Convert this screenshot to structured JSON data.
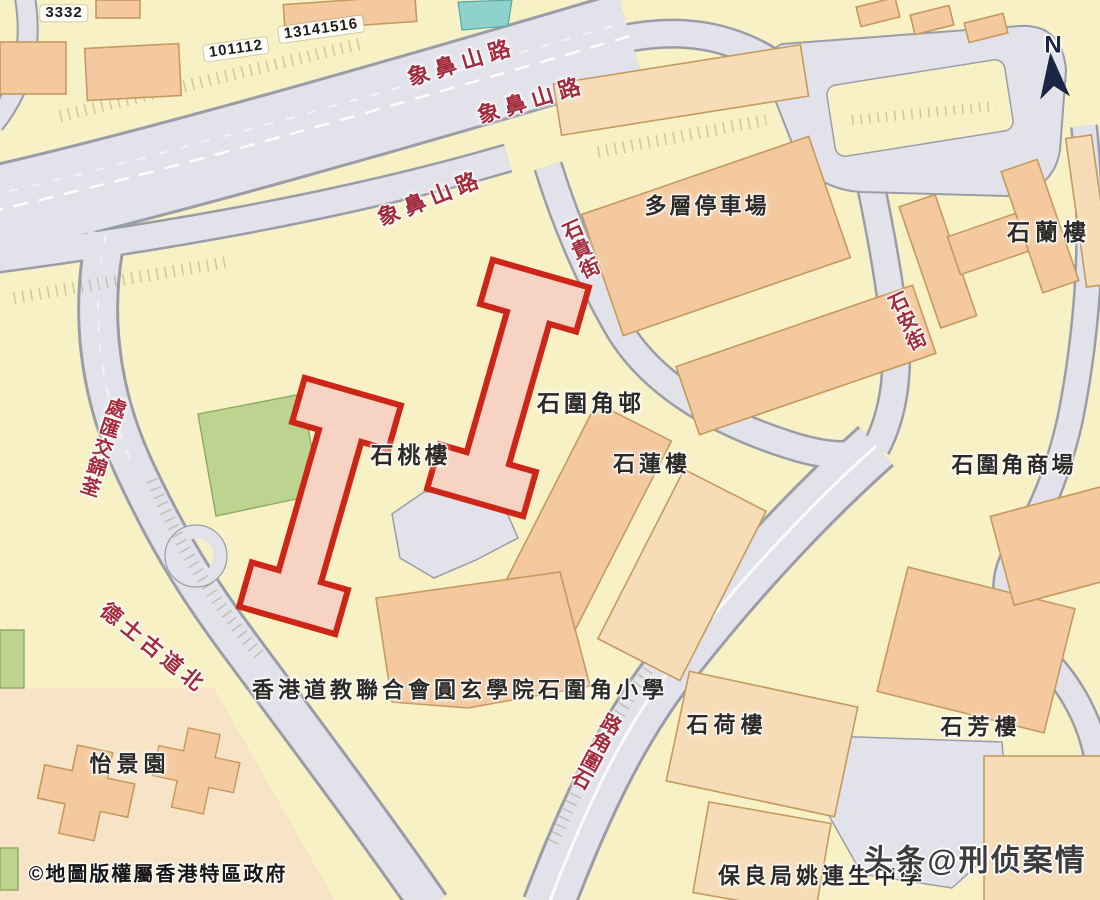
{
  "map": {
    "region_name": "石圍角邨",
    "highlighted_building": "石桃樓",
    "colors": {
      "base": "#f8f1c6",
      "road": "#e2e3ea",
      "roadEdge": "#9a9da8",
      "building": "#f4c99f",
      "buildingLight": "#f7dcb8",
      "buildingEdge": "#c49a5e",
      "paleBlock": "#f7e3c5",
      "green": "#bcd48f",
      "greenEdge": "#8fa95e",
      "teal": "#8fd2cc",
      "redLine": "#cd2518",
      "redFill": "#f6d3c3",
      "roadLabel": "#a32b3e",
      "placeLabel": "#2b2a27",
      "watermark": "#3c3c3c",
      "compass": "#1b2544"
    },
    "compass": {
      "label": "N"
    },
    "labels": [
      {
        "id": "lot-label-3332",
        "type": "pill",
        "text": "3332",
        "x": 64,
        "y": 13,
        "rot": 0,
        "size": 15,
        "ls": 1
      },
      {
        "id": "lot-label-101112",
        "type": "pill",
        "text": "101112",
        "x": 236,
        "y": 49,
        "rot": -8,
        "size": 15,
        "ls": 1
      },
      {
        "id": "lot-label-13141516",
        "type": "pill",
        "text": "13141516",
        "x": 321,
        "y": 29,
        "rot": -8,
        "size": 15,
        "ls": 1
      },
      {
        "id": "road-label-cheung-pei-shan-road-1",
        "type": "road",
        "text": "象鼻山路",
        "x": 462,
        "y": 63,
        "rot": -17,
        "size": 22,
        "ls": 6
      },
      {
        "id": "road-label-cheung-pei-shan-road-2",
        "type": "road",
        "text": "象鼻山路",
        "x": 532,
        "y": 101,
        "rot": -17,
        "size": 22,
        "ls": 6
      },
      {
        "id": "road-label-cheung-pei-shan-road-3",
        "type": "road",
        "text": "象鼻山路",
        "x": 431,
        "y": 199,
        "rot": -22,
        "size": 22,
        "ls": 6
      },
      {
        "id": "road-label-shek-kwai-street",
        "type": "road",
        "text": "石貴街",
        "x": 582,
        "y": 250,
        "rot": -24,
        "size": 20,
        "vertical": true
      },
      {
        "id": "road-label-shek-on-street",
        "type": "road",
        "text": "石安街",
        "x": 908,
        "y": 322,
        "rot": -25,
        "size": 20,
        "vertical": true
      },
      {
        "id": "road-label-tsuen-kam-interchange",
        "type": "road",
        "text": "荃錦交匯處",
        "x": 103,
        "y": 449,
        "rot": 18,
        "size": 20,
        "vertical": true,
        "reverse": true
      },
      {
        "id": "road-label-texaco-road-north",
        "type": "road",
        "text": "德士古道北",
        "x": 153,
        "y": 649,
        "rot": 39,
        "size": 21,
        "ls": 5
      },
      {
        "id": "road-label-shek-wai-kok-road",
        "type": "road",
        "text": "石圍角路",
        "x": 596,
        "y": 753,
        "rot": 28,
        "size": 20,
        "vertical": true,
        "reverse": true
      },
      {
        "id": "place-label-multistorey-car-park",
        "type": "place",
        "text": "多層停車場",
        "x": 707,
        "y": 207,
        "rot": 0,
        "size": 22,
        "ls": 3
      },
      {
        "id": "place-label-shek-lan-house",
        "type": "place",
        "text": "石蘭樓",
        "x": 1049,
        "y": 233,
        "rot": 0,
        "size": 23,
        "ls": 5
      },
      {
        "id": "place-label-shek-wai-kok-estate",
        "type": "place",
        "text": "石圍角邨",
        "x": 591,
        "y": 404,
        "rot": 0,
        "size": 23,
        "ls": 4
      },
      {
        "id": "place-label-shek-to-house",
        "type": "place",
        "text": "石桃樓",
        "x": 411,
        "y": 456,
        "rot": 0,
        "size": 23,
        "ls": 4
      },
      {
        "id": "place-label-shek-lin-house",
        "type": "place",
        "text": "石蓮樓",
        "x": 652,
        "y": 465,
        "rot": 0,
        "size": 22,
        "ls": 4
      },
      {
        "id": "place-label-shek-wai-kok-shopping-centre",
        "type": "place",
        "text": "石圍角商場",
        "x": 1014,
        "y": 466,
        "rot": 0,
        "size": 22,
        "ls": 3
      },
      {
        "id": "place-label-yuen-yuen-institute-primary-school",
        "type": "place",
        "text": "香港道教聯合會圓玄學院石圍角小學",
        "x": 460,
        "y": 691,
        "rot": 0,
        "size": 22,
        "ls": 4
      },
      {
        "id": "place-label-yee-king-garden",
        "type": "place",
        "text": "怡景園",
        "x": 130,
        "y": 765,
        "rot": 0,
        "size": 22,
        "ls": 5
      },
      {
        "id": "place-label-shek-ho-house",
        "type": "place",
        "text": "石荷樓",
        "x": 727,
        "y": 726,
        "rot": 0,
        "size": 22,
        "ls": 5
      },
      {
        "id": "place-label-shek-fong-house",
        "type": "place",
        "text": "石芳樓",
        "x": 981,
        "y": 728,
        "rot": 0,
        "size": 22,
        "ls": 5
      },
      {
        "id": "place-label-po-leung-kuk-yao-ling-sun-college",
        "type": "place",
        "text": "保良局姚連生中學",
        "x": 822,
        "y": 877,
        "rot": 0,
        "size": 22,
        "ls": 4
      },
      {
        "id": "copyright-notice",
        "type": "copyright",
        "text": "©地圖版權屬香港特區政府",
        "x": 158,
        "y": 875,
        "rot": 0,
        "size": 20,
        "ls": 2
      },
      {
        "id": "watermark-toutiao",
        "type": "watermark",
        "text": "头条@刑侦案情",
        "x": 975,
        "y": 861,
        "rot": 0,
        "size": 30,
        "ls": 2
      },
      {
        "id": "compass-north-label",
        "type": "compass",
        "text": "N",
        "x": 1053,
        "y": 46,
        "rot": 0,
        "size": 24,
        "ls": 0
      }
    ]
  }
}
